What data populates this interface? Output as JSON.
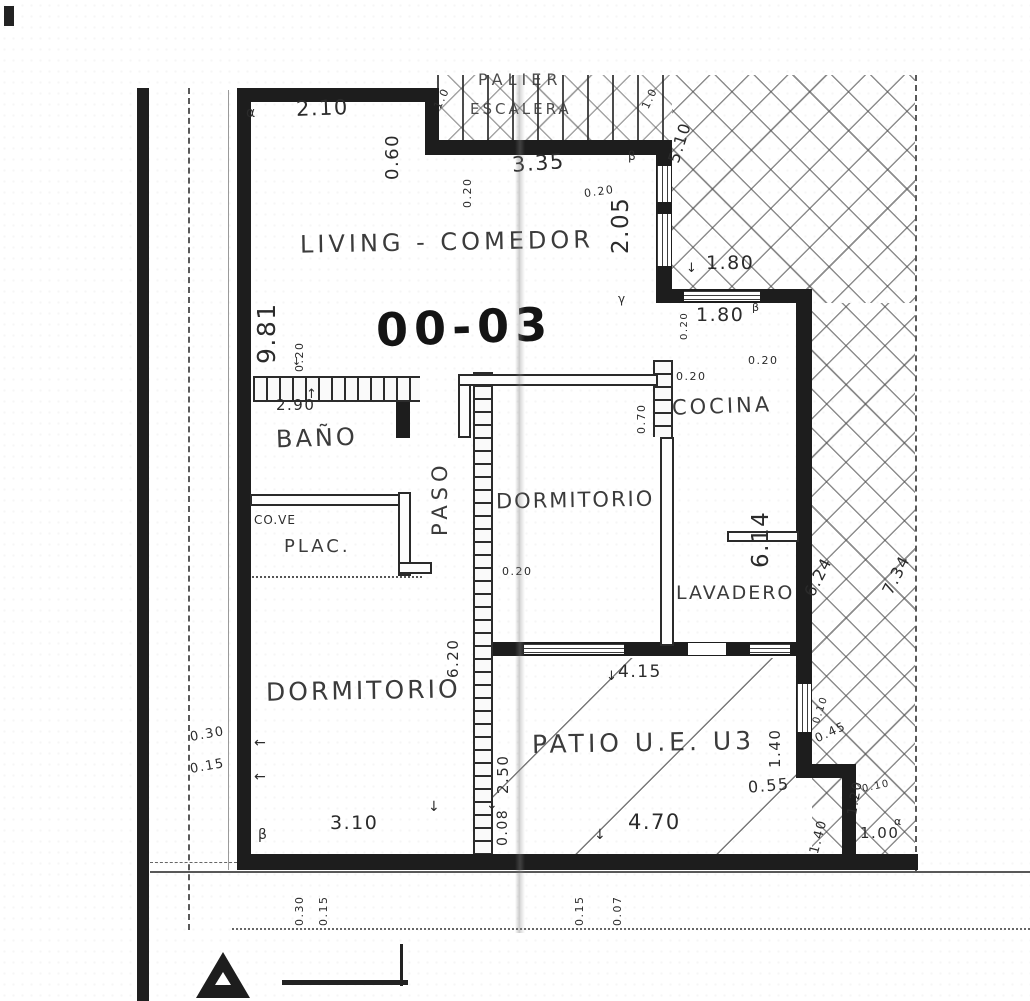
{
  "colors": {
    "ink": "#1d1d1d",
    "hatch_line": "#6a6a6a",
    "paper": "#ffffff"
  },
  "plan": {
    "unit_label": "00-03",
    "rooms": {
      "palier": "PALIER",
      "escalera": "ESCALERA",
      "living": "LIVING - COMEDOR",
      "bano": "BAÑO",
      "cove": "CO.VE",
      "plac": "PLAC.",
      "paso": "PASO",
      "dorm_center": "DORMITORIO",
      "cocina": "COCINA",
      "lavadero": "LAVADERO",
      "dorm_sw": "DORMITORIO",
      "patio": "PATIO U.E. U3"
    },
    "dims": [
      {
        "t": "2.10"
      },
      {
        "t": "0.60"
      },
      {
        "t": "α"
      },
      {
        "t": "1.0"
      },
      {
        "t": "1.0"
      },
      {
        "t": "3.35"
      },
      {
        "t": "0.20"
      },
      {
        "t": "0.20"
      },
      {
        "t": "2.05"
      },
      {
        "t": "5.10"
      },
      {
        "t": "β"
      },
      {
        "t": "1.80"
      },
      {
        "t": "1.80"
      },
      {
        "t": "0.20"
      },
      {
        "t": "β"
      },
      {
        "t": "9.81"
      },
      {
        "t": "0.20"
      },
      {
        "t": "2.90"
      },
      {
        "t": "0.20"
      },
      {
        "t": "0.20"
      },
      {
        "t": "0.70"
      },
      {
        "t": "0.20"
      },
      {
        "t": "6.14"
      },
      {
        "t": "6.24"
      },
      {
        "t": "7.34"
      },
      {
        "t": "6.20"
      },
      {
        "t": "4.15"
      },
      {
        "t": "1.40"
      },
      {
        "t": "2.50"
      },
      {
        "t": "0.08"
      },
      {
        "t": "0.30"
      },
      {
        "t": "0.15"
      },
      {
        "t": "3.10"
      },
      {
        "t": "β"
      },
      {
        "t": "4.70"
      },
      {
        "t": "0.55"
      },
      {
        "t": "0.10"
      },
      {
        "t": "0.45"
      },
      {
        "t": "1.20"
      },
      {
        "t": "0.10"
      },
      {
        "t": "1.40"
      },
      {
        "t": "1.00"
      },
      {
        "t": "α"
      },
      {
        "t": "0.30"
      },
      {
        "t": "0.15"
      },
      {
        "t": "0.15"
      },
      {
        "t": "0.07"
      },
      {
        "t": "γ"
      }
    ],
    "marks": [
      {
        "t": "↓"
      },
      {
        "t": "↑"
      },
      {
        "t": "↓"
      },
      {
        "t": "↓"
      },
      {
        "t": "↓"
      },
      {
        "t": "↓"
      },
      {
        "t": "←"
      },
      {
        "t": "←"
      },
      {
        "t": "↓"
      }
    ]
  }
}
